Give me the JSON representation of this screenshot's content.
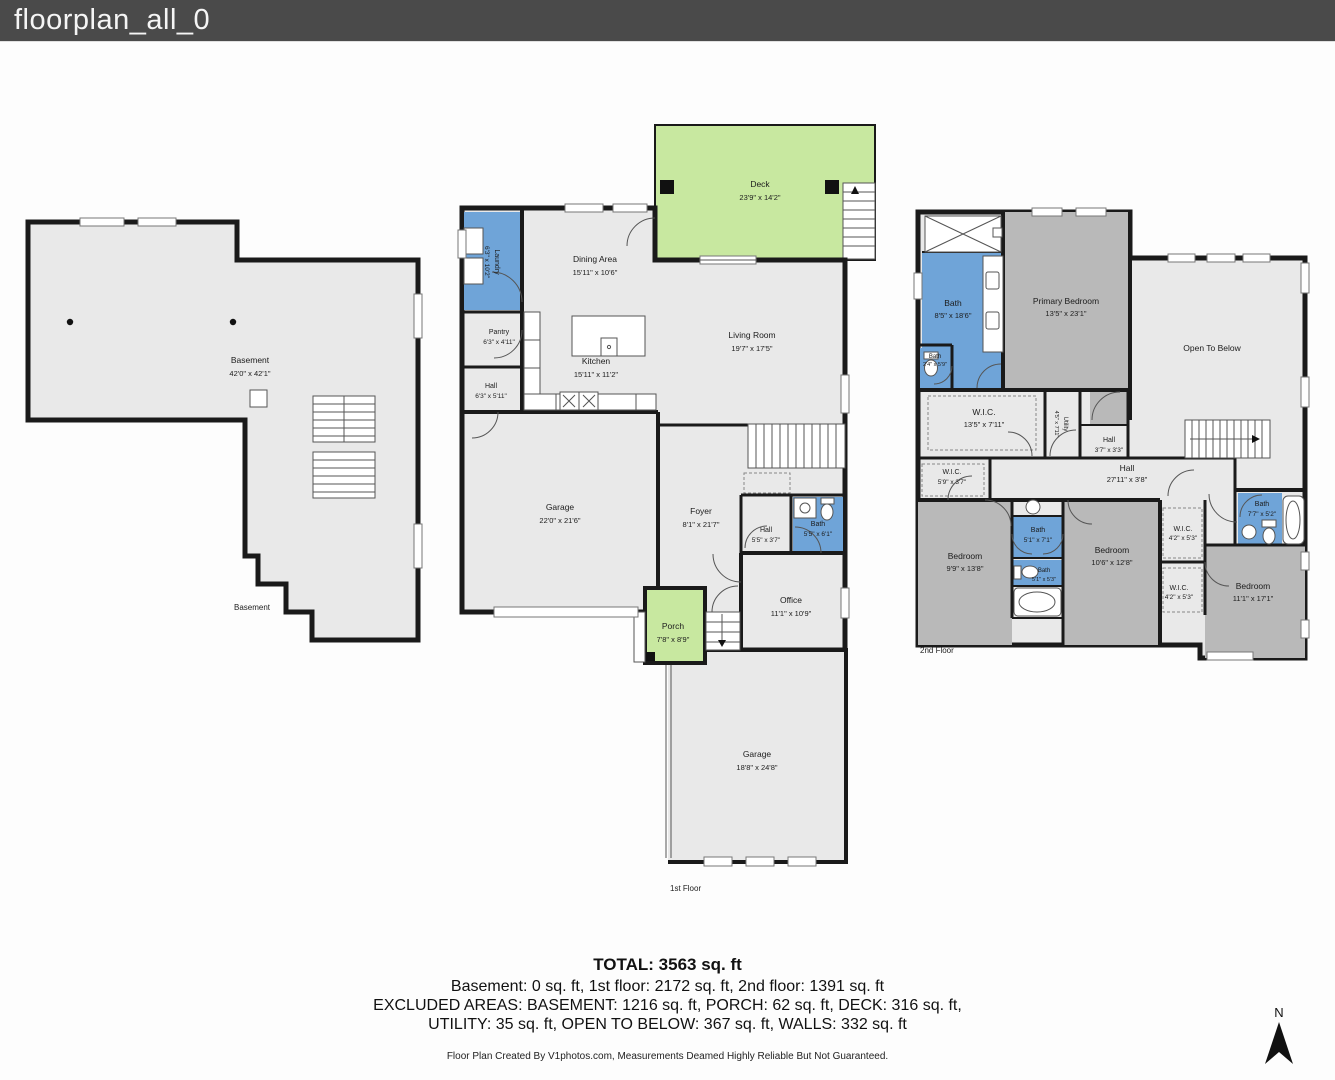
{
  "window": {
    "title": "floorplan_all_0"
  },
  "colors": {
    "title_bar": "#4a4a4a",
    "wall": "#1a1a1a",
    "floor": "#e9e9e9",
    "bedroom_fill": "#b9b9b9",
    "wet_room_fill": "#6fa4d8",
    "outdoor_fill": "#c8e8a0"
  },
  "floors": {
    "basement": {
      "caption": "Basement",
      "rooms": {
        "basement": {
          "name": "Basement",
          "dims": "42'0\" x 42'1\""
        }
      }
    },
    "first": {
      "caption": "1st Floor",
      "rooms": {
        "deck": {
          "name": "Deck",
          "dims": "23'9\" x 14'2\""
        },
        "laundry": {
          "name": "Laundry",
          "dims": "6'3\" x 10'2\""
        },
        "dining": {
          "name": "Dining Area",
          "dims": "15'11\" x 10'6\""
        },
        "pantry": {
          "name": "Pantry",
          "dims": "6'3\" x 4'11\""
        },
        "kitchen": {
          "name": "Kitchen",
          "dims": "15'11\" x 11'2\""
        },
        "hall_top": {
          "name": "Hall",
          "dims": "6'3\" x 5'11\""
        },
        "living": {
          "name": "Living Room",
          "dims": "19'7\" x 17'5\""
        },
        "garage_main": {
          "name": "Garage",
          "dims": "22'0\" x 21'6\""
        },
        "foyer": {
          "name": "Foyer",
          "dims": "8'1\" x 21'7\""
        },
        "hall_mid": {
          "name": "Hall",
          "dims": "5'5\" x 3'7\""
        },
        "bath": {
          "name": "Bath",
          "dims": "5'5\" x 6'1\""
        },
        "office": {
          "name": "Office",
          "dims": "11'1\" x 10'9\""
        },
        "porch": {
          "name": "Porch",
          "dims": "7'8\" x 8'9\""
        },
        "garage_lower": {
          "name": "Garage",
          "dims": "18'8\" x 24'8\""
        }
      }
    },
    "second": {
      "caption": "2nd Floor",
      "rooms": {
        "bath_primary": {
          "name": "Bath",
          "dims": "8'5\" x 18'6\""
        },
        "bath_small": {
          "name": "Bath",
          "dims": "2'4\" x 5'9\""
        },
        "primary_bedroom": {
          "name": "Primary Bedroom",
          "dims": "13'5\" x 23'1\""
        },
        "open_below": {
          "name": "Open To Below"
        },
        "wic_primary": {
          "name": "W.I.C.",
          "dims": "13'5\" x 7'11\""
        },
        "utility": {
          "name": "Utility",
          "dims": "4'5\" x 7'11\""
        },
        "hall_small": {
          "name": "Hall",
          "dims": "3'7\" x 3'3\""
        },
        "wic_small": {
          "name": "W.I.C.",
          "dims": "5'9\" x 3'7\""
        },
        "hall_long": {
          "name": "Hall",
          "dims": "27'11\" x 3'8\""
        },
        "bedroom_left": {
          "name": "Bedroom",
          "dims": "9'9\" x 13'8\""
        },
        "bath_mid_top": {
          "name": "Bath",
          "dims": "5'1\" x 7'1\""
        },
        "bath_mid_bottom": {
          "name": "Bath",
          "dims": "5'1\" x 5'3\""
        },
        "bedroom_mid": {
          "name": "Bedroom",
          "dims": "10'6\" x 12'8\""
        },
        "wic_top": {
          "name": "W.I.C.",
          "dims": "4'2\" x 5'3\""
        },
        "wic_bottom": {
          "name": "W.I.C.",
          "dims": "4'2\" x 5'3\""
        },
        "bath_right": {
          "name": "Bath",
          "dims": "7'7\" x 5'2\""
        },
        "bedroom_right": {
          "name": "Bedroom",
          "dims": "11'1\" x 17'1\""
        }
      }
    }
  },
  "summary": {
    "total": "TOTAL: 3563 sq. ft",
    "line1": "Basement: 0 sq. ft, 1st floor: 2172 sq. ft, 2nd floor: 1391 sq. ft",
    "line2": "EXCLUDED AREAS: BASEMENT: 1216 sq. ft, PORCH: 62 sq. ft, DECK: 316 sq. ft,",
    "line3": "UTILITY: 35 sq. ft, OPEN TO BELOW: 367 sq. ft, WALLS: 332 sq. ft",
    "credit": "Floor Plan Created By V1photos.com, Measurements Deamed Highly Reliable But Not Guaranteed."
  },
  "compass": {
    "label": "N"
  }
}
